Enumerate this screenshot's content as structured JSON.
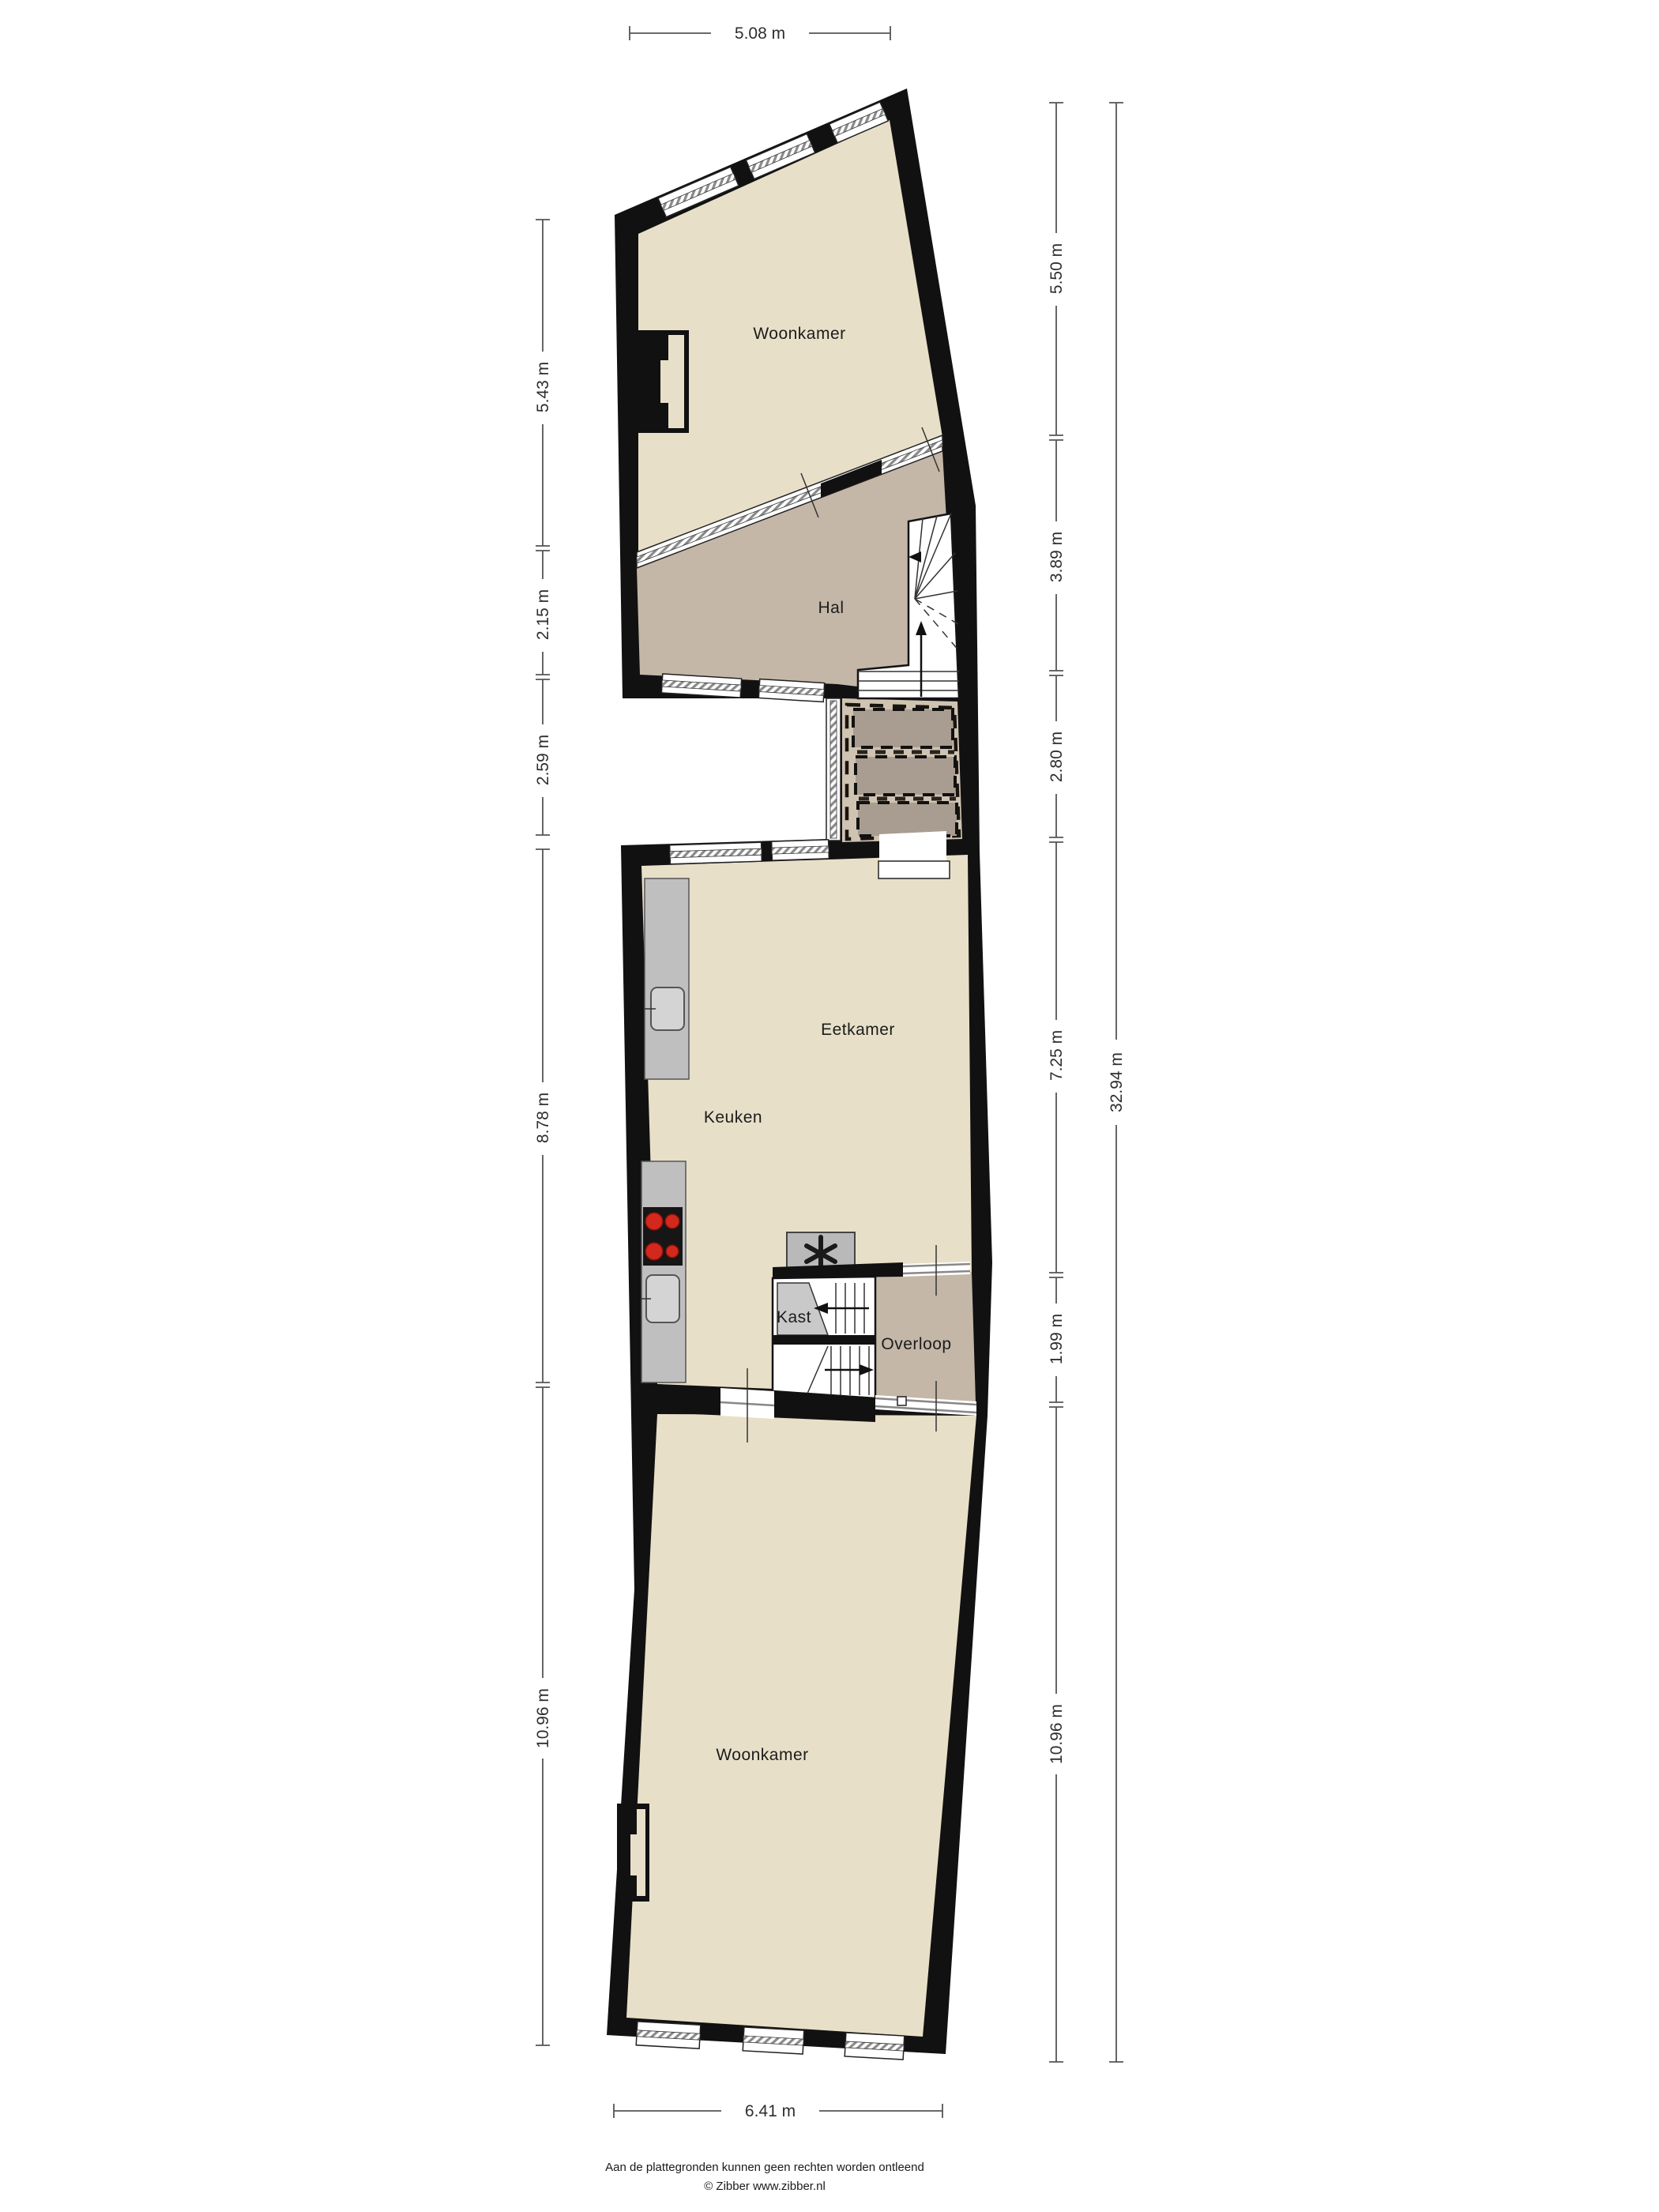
{
  "rooms": [
    {
      "id": "woonkamer-boven",
      "label": "Woonkamer"
    },
    {
      "id": "hal",
      "label": "Hal"
    },
    {
      "id": "eetkamer",
      "label": "Eetkamer"
    },
    {
      "id": "keuken",
      "label": "Keuken"
    },
    {
      "id": "kast",
      "label": "Kast"
    },
    {
      "id": "overloop",
      "label": "Overloop"
    },
    {
      "id": "woonkamer-beneden",
      "label": "Woonkamer"
    }
  ],
  "dimensions": {
    "top": "5.08 m",
    "bottom": "6.41 m",
    "left": [
      "5.43 m",
      "2.15 m",
      "2.59 m",
      "8.78 m",
      "10.96 m"
    ],
    "right": [
      "5.50 m",
      "3.89 m",
      "2.80 m",
      "7.25 m",
      "1.99 m",
      "10.96 m"
    ],
    "right_total": "32.94 m"
  },
  "footer": {
    "disclaimer": "Aan de plattegronden kunnen geen rechten worden ontleend",
    "credit": "© Zibber www.zibber.nl"
  },
  "colors": {
    "wall": "#111111",
    "floor": "#e7dfc8",
    "hal": "#c4b7a8",
    "court": "#cfc3b2",
    "sky": "#a89d90",
    "counter": "#bfbfbf",
    "sink": "#d4d4d4",
    "stove": "#161616",
    "burner": "#d2281e",
    "unit": "#b9b9b9",
    "wedge": "#c9c9c9",
    "dim": "#555555",
    "dimtext": "#2e2e2e",
    "roomtext": "#1c1c1c"
  }
}
